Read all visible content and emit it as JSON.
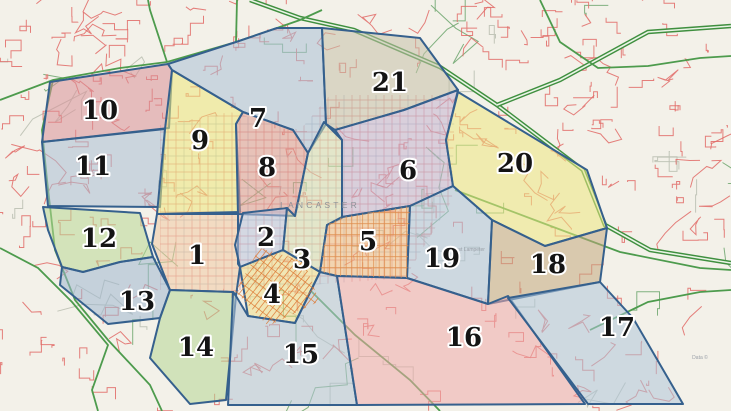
{
  "map": {
    "city_label": "LANCASTER",
    "attribution": "Data ©",
    "place_labels": [
      {
        "text": "West Lampeter",
        "x": 468,
        "y": 251
      }
    ],
    "colors": {
      "bg": "#f3f1e9",
      "street": "#e06a66",
      "road_thin": "#74aa74",
      "gray_road": "#bcc1b4",
      "road": "#4d9b4d",
      "hwy": "#3f8f3f",
      "hwy_inner": "#eaf4e6",
      "border": "#35608d",
      "label": "#141414",
      "halo": "#ffffff",
      "city_label": "#8b8f96",
      "place_label": "#9aa0a8"
    },
    "wards": [
      {
        "num": "10",
        "fill": "#d88f97",
        "lx": 100,
        "ly": 110,
        "points": "50,82 168,64 172,70 169,128 42,142"
      },
      {
        "num": "11",
        "fill": "#a9bdd4",
        "lx": 93,
        "ly": 166,
        "points": "42,142 165,129 160,207 48,206"
      },
      {
        "num": "9",
        "fill": "#ece67a",
        "lx": 200,
        "ly": 140,
        "points": "172,70 243,112 236,124 240,212 157,214 165,129"
      },
      {
        "num": "7",
        "fill": "#aabfd6",
        "lx": 258,
        "ly": 118,
        "points": "168,64 236,42 277,28 322,28 326,124 308,153 293,130 243,112 172,70"
      },
      {
        "num": "8",
        "fill": "#dd9a90",
        "lx": 267,
        "ly": 167,
        "points": "243,112 293,130 308,153 295,216 238,214 236,124"
      },
      {
        "num": "21",
        "fill": "#c5c0a8",
        "lx": 390,
        "ly": 82,
        "points": "322,28 420,38 458,90 404,110 335,130 326,124"
      },
      {
        "num": "6",
        "fill": "#c3b3cf",
        "lx": 408,
        "ly": 170,
        "points": "335,130 404,110 458,90 446,140 453,186 410,206 342,217 342,140"
      },
      {
        "num": "20",
        "fill": "#ece67f",
        "lx": 515,
        "ly": 163,
        "points": "458,92 587,170 607,228 545,246 492,220 453,186 446,140"
      },
      {
        "num": "12",
        "fill": "#b8d793",
        "lx": 99,
        "ly": 238,
        "points": "43,207 140,213 153,257 120,262 83,272 62,267 48,230"
      },
      {
        "num": "1",
        "fill": "#f0c9a2",
        "lx": 197,
        "ly": 255,
        "points": "157,214 238,214 238,264 240,267 236,296 233,292 170,290 152,244"
      },
      {
        "num": "2",
        "fill": "#b9c3dd",
        "lx": 266,
        "ly": 237,
        "points": "243,213 287,208 283,250 240,267 235,245"
      },
      {
        "num": "3",
        "fill": "#d6ddb0",
        "lx": 302,
        "ly": 259,
        "points": "308,153 324,122 342,140 342,218 327,225 320,272 283,250 287,208 295,216"
      },
      {
        "num": "5",
        "fill": "#f0bb83",
        "lx": 368,
        "ly": 241,
        "points": "342,217 410,206 407,278 337,276 320,272 327,225"
      },
      {
        "num": "19",
        "fill": "#adc2d8",
        "lx": 442,
        "ly": 258,
        "points": "410,206 453,186 492,220 488,304 407,278"
      },
      {
        "num": "18",
        "fill": "#c2a87e",
        "lx": 548,
        "ly": 264,
        "points": "492,220 545,246 607,228 600,282 488,304"
      },
      {
        "num": "4",
        "fill": "#eedd88",
        "lx": 272,
        "ly": 294,
        "points": "240,267 283,250 320,272 295,323 248,316"
      },
      {
        "num": "13",
        "fill": "#9fb6d0",
        "lx": 137,
        "ly": 301,
        "points": "62,267 83,272 120,262 153,257 170,290 160,318 108,324 60,285"
      },
      {
        "num": "14",
        "fill": "#b4d694",
        "lx": 196,
        "ly": 347,
        "points": "170,290 233,292 236,296 226,400 190,404 150,358 160,318"
      },
      {
        "num": "15",
        "fill": "#b3c4d6",
        "lx": 301,
        "ly": 354,
        "points": "233,292 236,296 248,316 295,323 320,272 337,276 357,405 228,405"
      },
      {
        "num": "16",
        "fill": "#efa9a9",
        "lx": 464,
        "ly": 337,
        "points": "337,276 407,278 488,304 508,296 585,404 357,405"
      },
      {
        "num": "17",
        "fill": "#aec5d9",
        "lx": 617,
        "ly": 327,
        "points": "600,282 633,318 683,404 588,404 508,298"
      }
    ],
    "roads": [
      {
        "type": "hwy",
        "pts": [
          [
            250,
            0
          ],
          [
            300,
            18
          ],
          [
            354,
            30
          ],
          [
            440,
            67
          ],
          [
            497,
            105
          ],
          [
            583,
            170
          ],
          [
            605,
            225
          ],
          [
            650,
            250
          ],
          [
            731,
            263
          ]
        ]
      },
      {
        "type": "hwy",
        "pts": [
          [
            497,
            105
          ],
          [
            560,
            80
          ],
          [
            648,
            32
          ],
          [
            731,
            26
          ]
        ]
      },
      {
        "type": "road",
        "pts": [
          [
            0,
            100
          ],
          [
            53,
            80
          ],
          [
            120,
            68
          ],
          [
            167,
            62
          ],
          [
            236,
            42
          ],
          [
            277,
            28
          ],
          [
            300,
            20
          ],
          [
            322,
            10
          ]
        ]
      },
      {
        "type": "road",
        "pts": [
          [
            167,
            62
          ],
          [
            150,
            10
          ],
          [
            148,
            0
          ]
        ]
      },
      {
        "type": "road",
        "pts": [
          [
            236,
            42
          ],
          [
            237,
            0
          ]
        ]
      },
      {
        "type": "road",
        "pts": [
          [
            53,
            80
          ],
          [
            42,
            130
          ],
          [
            47,
            180
          ],
          [
            55,
            250
          ],
          [
            75,
            300
          ],
          [
            108,
            340
          ],
          [
            150,
            385
          ],
          [
            162,
            411
          ]
        ]
      },
      {
        "type": "road",
        "pts": [
          [
            310,
            290
          ],
          [
            355,
            335
          ],
          [
            410,
            380
          ],
          [
            440,
            411
          ]
        ]
      },
      {
        "type": "road",
        "pts": [
          [
            455,
            190
          ],
          [
            540,
            222
          ],
          [
            620,
            252
          ],
          [
            700,
            268
          ],
          [
            731,
            270
          ]
        ]
      },
      {
        "type": "road",
        "pts": [
          [
            540,
            0
          ],
          [
            560,
            42
          ],
          [
            598,
            68
          ],
          [
            648,
            66
          ],
          [
            700,
            58
          ],
          [
            731,
            56
          ]
        ]
      },
      {
        "type": "road",
        "pts": [
          [
            0,
            248
          ],
          [
            38,
            268
          ],
          [
            72,
            302
          ],
          [
            108,
            345
          ],
          [
            92,
            390
          ],
          [
            98,
            411
          ]
        ]
      },
      {
        "type": "road",
        "pts": [
          [
            590,
            330
          ],
          [
            648,
            302
          ],
          [
            700,
            292
          ],
          [
            731,
            290
          ]
        ]
      }
    ],
    "core_grid": {
      "clip": "160,125 230,112 300,130 330,95 455,95 452,200 405,278 240,290 160,290",
      "step": 8
    },
    "dense_grids": [
      {
        "ward": "4",
        "angle": 38,
        "step": 5,
        "color": "#dd7a35"
      },
      {
        "ward": "5",
        "angle": 0,
        "step": 5.5,
        "color": "#df8d4d"
      }
    ]
  }
}
